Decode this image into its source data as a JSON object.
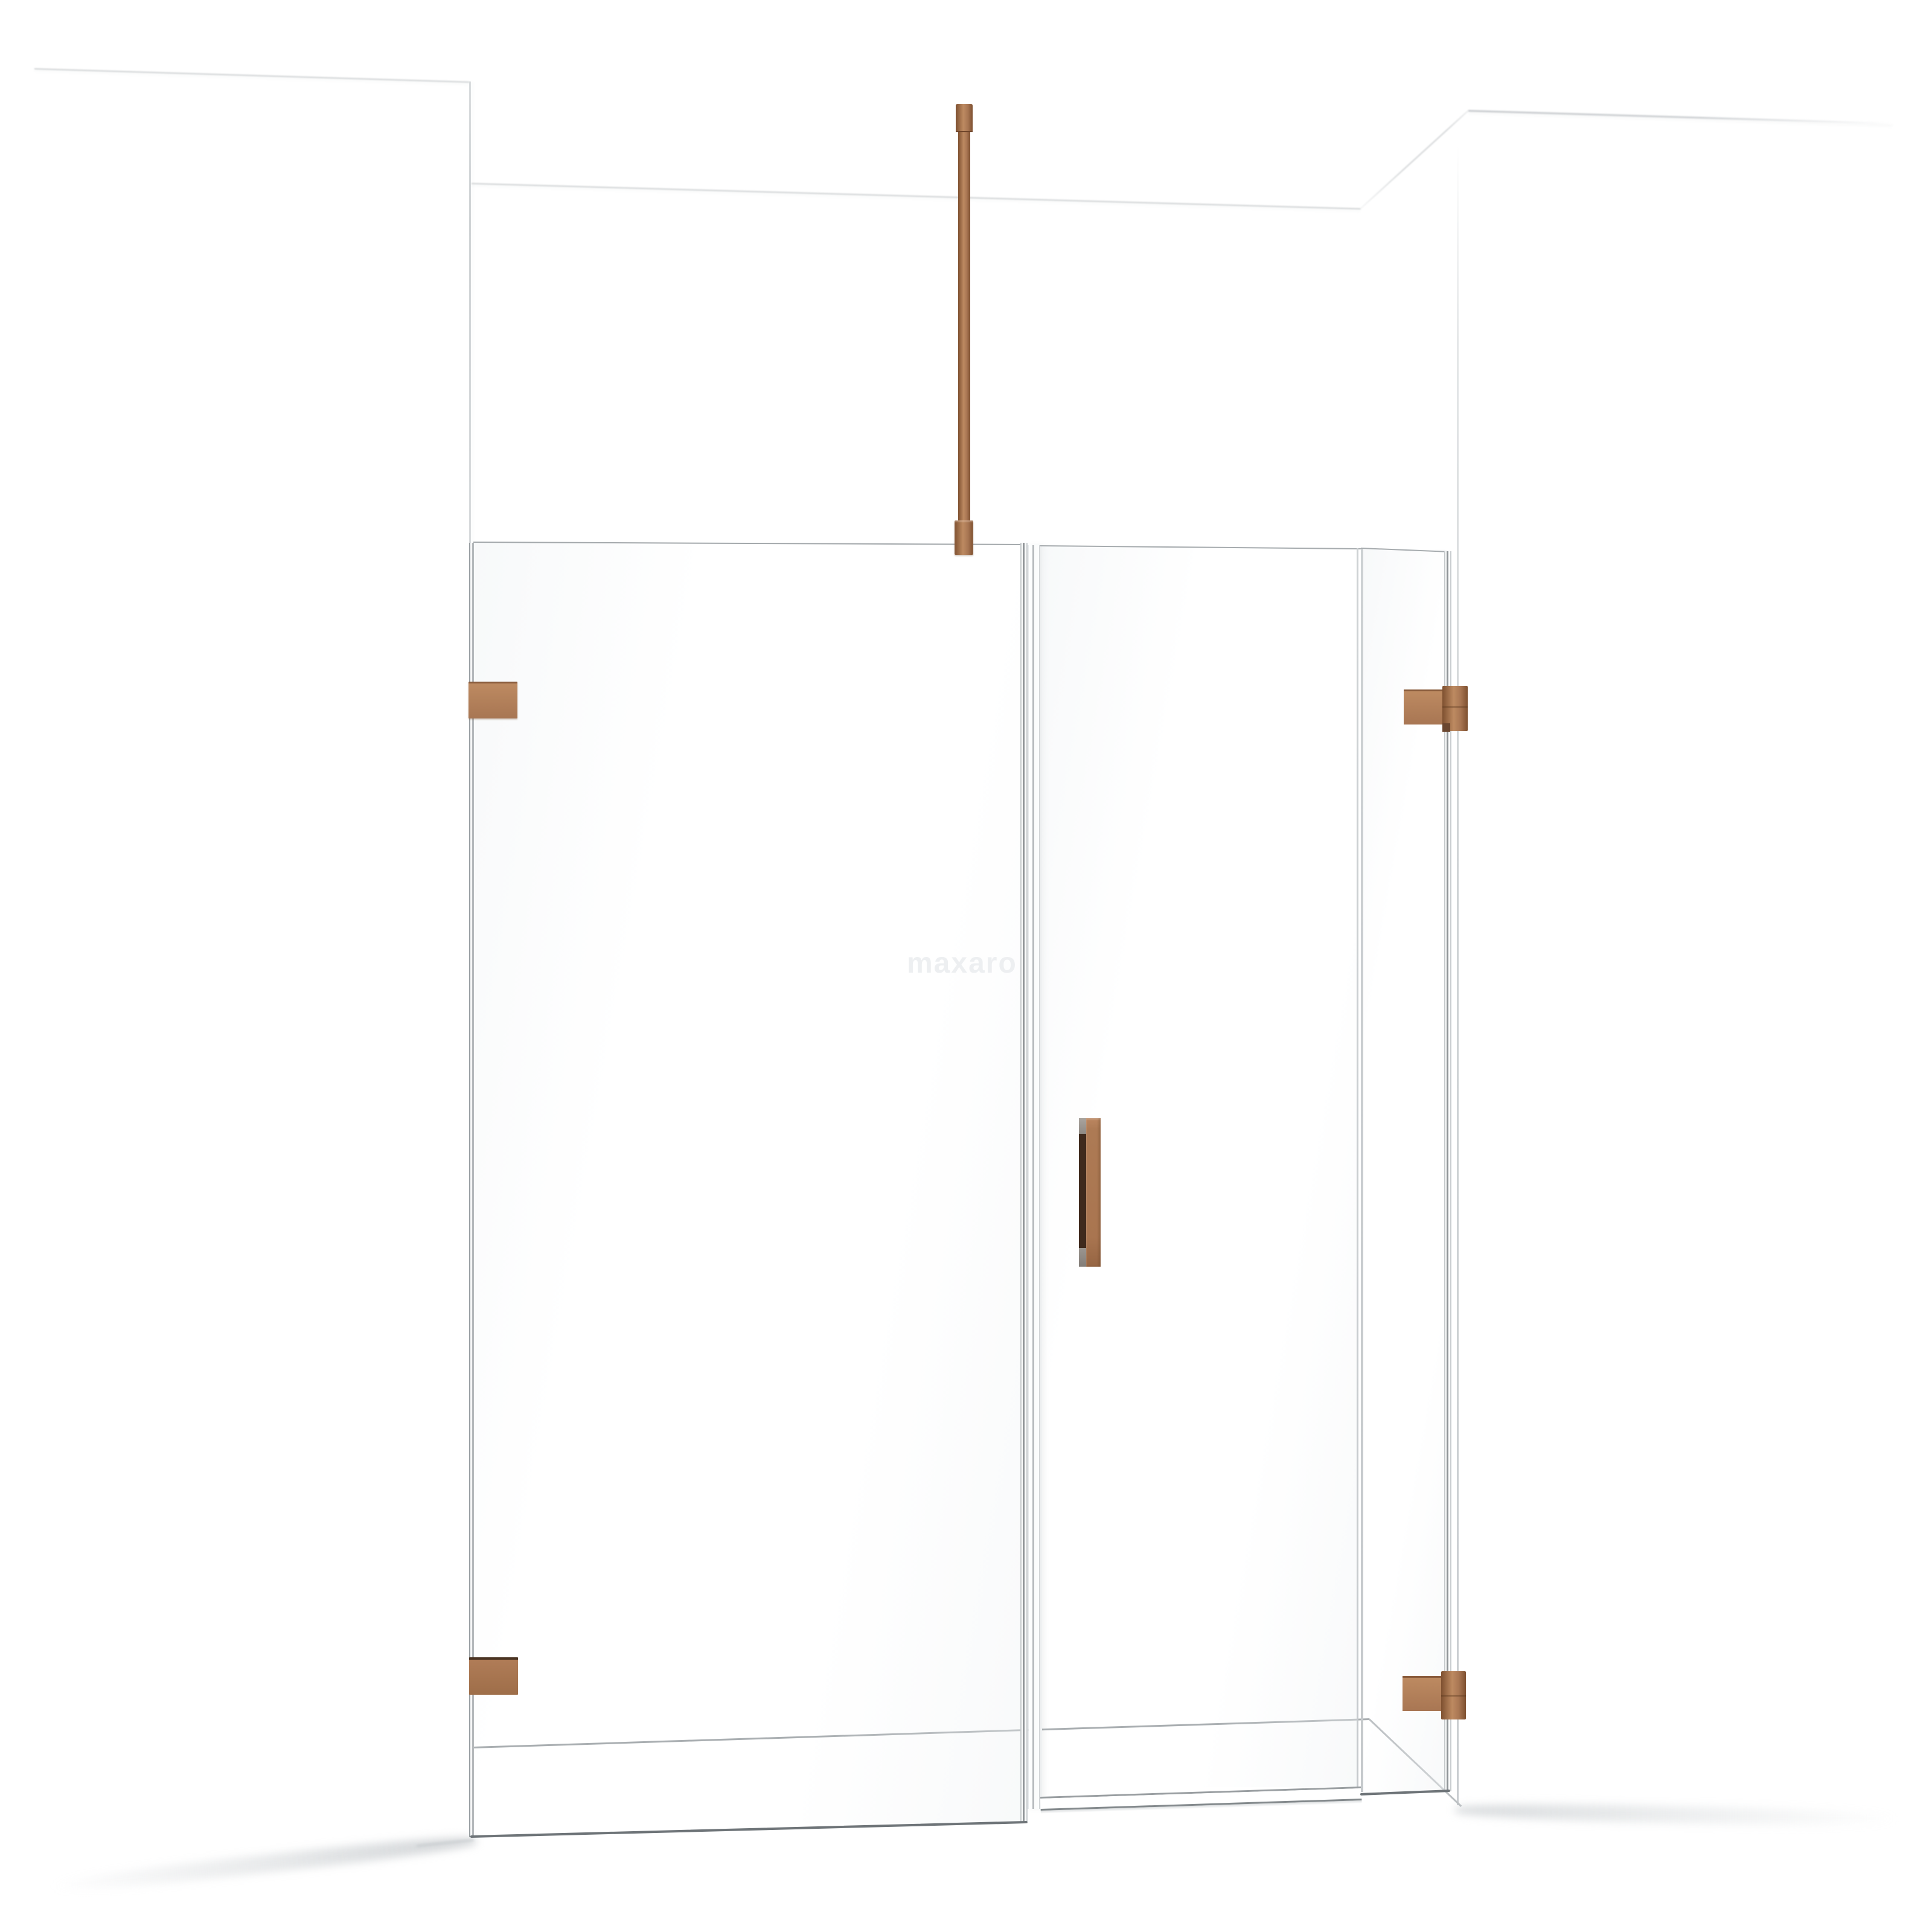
{
  "watermark": {
    "text": "maxaro"
  },
  "colors": {
    "background": "#ffffff",
    "copper": "#a87653",
    "copper_light": "#bd8a61",
    "copper_dark": "#8a5c3c",
    "copper_edge": "#6f452a",
    "handle_slot": "#3f2a1d",
    "glass_edge": "#8f9497",
    "glass_edge_soft": "#c6cacc",
    "wall_line": "#cdd0d2",
    "floor_line": "#a9aeb1",
    "watermark_color": "#edeff1"
  }
}
